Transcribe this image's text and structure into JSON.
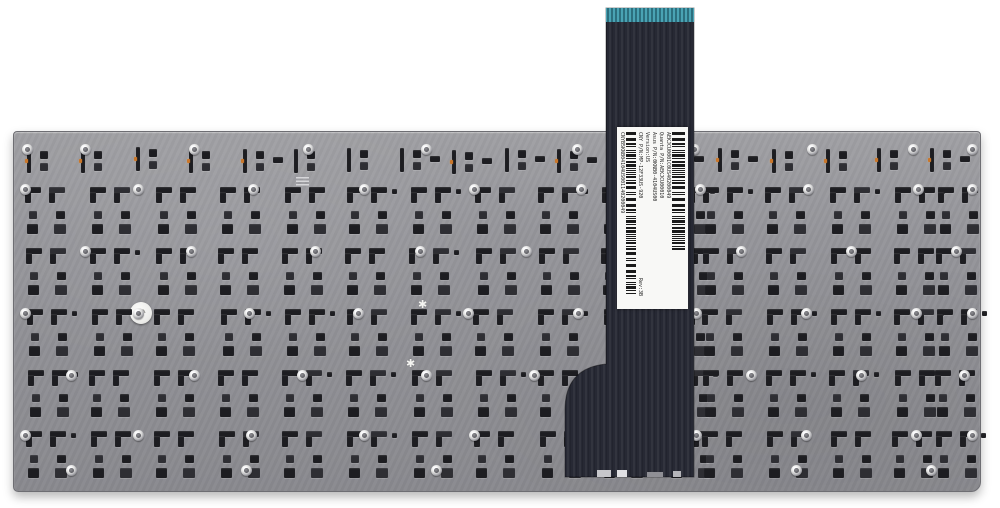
{
  "image_type": "product photo",
  "subject": "Laptop replacement keyboard, rear metal plate with flex ribbon cable",
  "label": {
    "serial_top": "AEKJCU0001C0US40200049",
    "quanta_pn": "Quanta P/N:AEKJCU00010",
    "asus_pn": "Asus P/N:0KNB0-4104US00",
    "version": "Version:US",
    "cny_pn": "CNY P/N:MP-12F33US-920",
    "rev": "Rev:3B",
    "serial_bottom": "CNYB5KNB04104US001140200049"
  },
  "marks": {
    "qc_star": "✱"
  },
  "colors": {
    "background": "#ffffff",
    "plate": "#95959a",
    "cutout": "#1d1d21",
    "cable": "#272934",
    "cable_contacts": "#3f93a4",
    "label_bg": "#f8f8f6",
    "rivet": "#dededd",
    "solder_dot": "#c9762a"
  }
}
